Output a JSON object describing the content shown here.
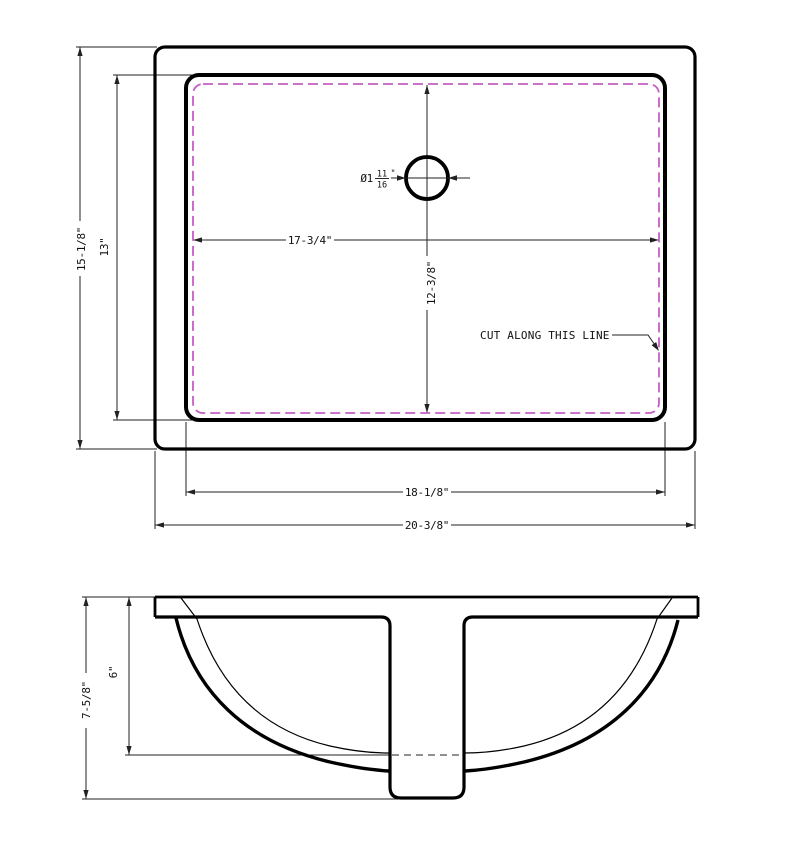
{
  "drawing": {
    "title": "Undermount sink cutout drawing",
    "colors": {
      "line": "#000000",
      "dimension": "#222222",
      "cut_line": "#c45ec4"
    },
    "top_view": {
      "overall_width": "20-3/8\"",
      "inner_width": "18-1/8\"",
      "cut_width": "17-3/4\"",
      "overall_height": "15-1/8\"",
      "inner_height": "13\"",
      "cut_height": "12-3/8\"",
      "drain": {
        "prefix": "Ø1",
        "numerator": "11",
        "denominator": "16",
        "unit": "\""
      },
      "note": "CUT ALONG THIS LINE"
    },
    "front_view": {
      "overall_depth": "7-5/8\"",
      "bowl_depth": "6\""
    }
  }
}
